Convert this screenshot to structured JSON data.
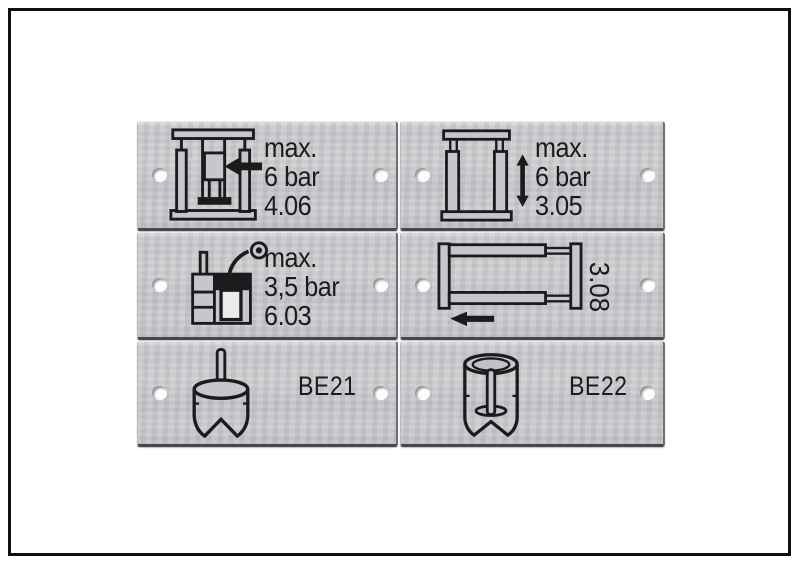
{
  "page": {
    "background": "#ffffff",
    "frame_color": "#0f0f0f"
  },
  "colors": {
    "plate_metal": "#c7c7cb",
    "plate_edge_dark": "#47474c",
    "ink": "#1b1b1e",
    "hole_fill": "#fdfdfd",
    "hole_rim": "#8f8f96"
  },
  "plates": [
    {
      "name": "plate-top-left",
      "icon": "press-ram-arrow-icon",
      "text_lines": [
        "max.",
        "6 bar",
        "4.06"
      ]
    },
    {
      "name": "plate-top-right",
      "icon": "frame-vertical-stroke-icon",
      "text_lines": [
        "max.",
        "6 bar",
        "3.05"
      ]
    },
    {
      "name": "plate-middle-left",
      "icon": "lubricator-spray-icon",
      "text_lines": [
        "max.",
        "3,5 bar",
        "6.03"
      ]
    },
    {
      "name": "plate-middle-right",
      "icon": "frame-horizontal-stroke-icon",
      "rotated_label": "3.08"
    },
    {
      "name": "plate-bottom-left",
      "icon": "cylinder-pin-top-icon",
      "label": "BE21"
    },
    {
      "name": "plate-bottom-right",
      "icon": "cylinder-pin-inside-icon",
      "label": "BE22"
    }
  ]
}
